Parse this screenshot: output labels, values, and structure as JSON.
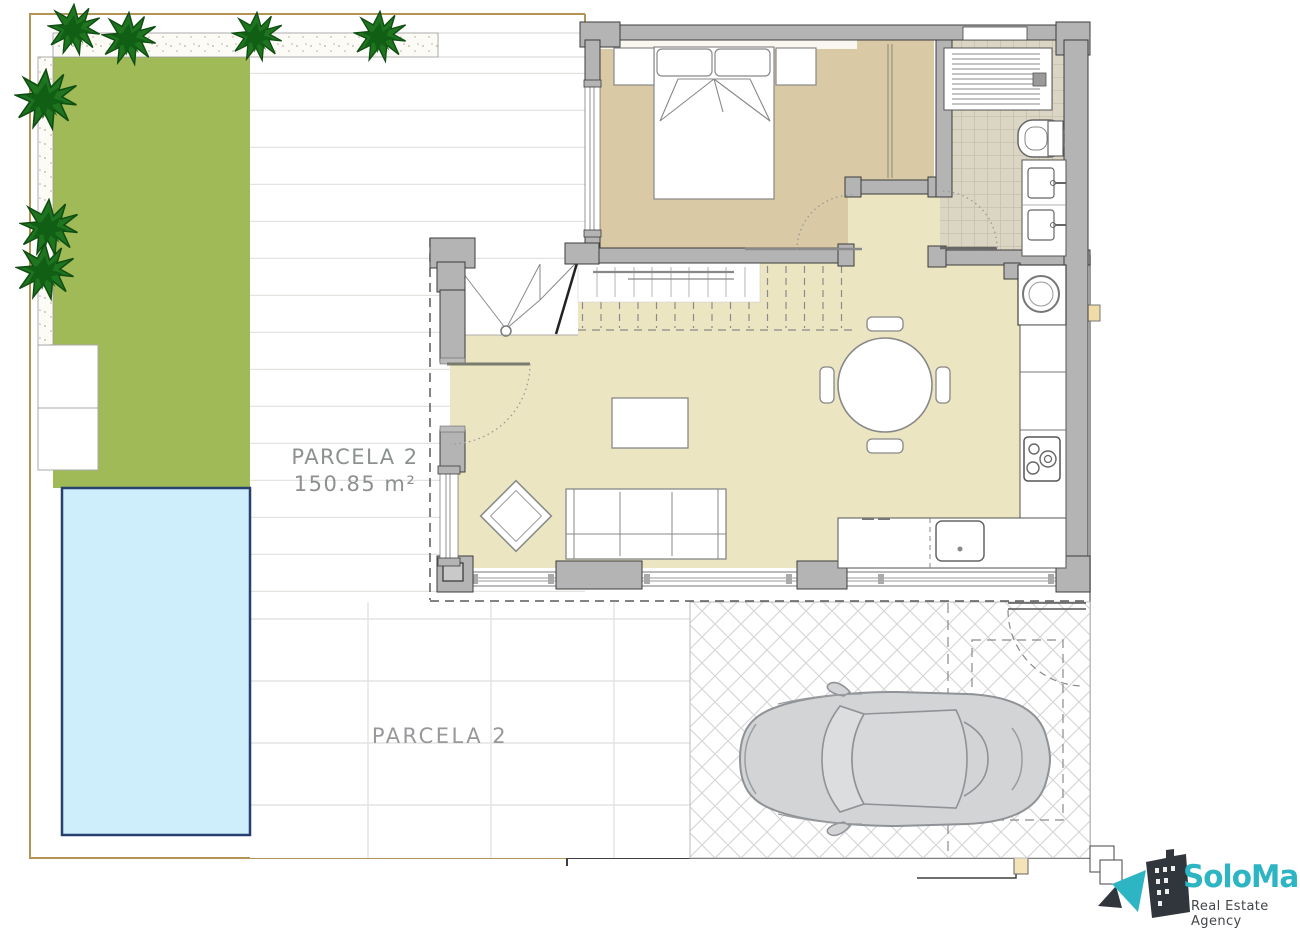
{
  "labels": {
    "parcel_main": {
      "title": "PARCELA 2",
      "area": "150.85 m²"
    },
    "parcel_bottom": {
      "title": "PARCELA 2"
    }
  },
  "logo": {
    "name": "SoloMar",
    "tagline": "Real Estate Agency"
  },
  "icons": {
    "tree": "tree-icon",
    "car": "car-top-view-icon",
    "bed": "double-bed-icon",
    "shower": "shower-icon",
    "toilet": "toilet-icon",
    "sink": "sink-icon",
    "washer": "washing-machine-icon",
    "hob": "cooktop-icon",
    "dining": "round-table-with-chairs-icon",
    "sofa": "sofa-icon",
    "logo_building": "building-icon"
  },
  "colors": {
    "wall": "#b4b4b4",
    "bedroom_floor": "#d9c9a4",
    "living_floor": "#ece5c2",
    "bath_tile": "#dbd6c3",
    "garden": "#9fba56",
    "pool_water": "#cdeefa",
    "pool_border": "#27406f",
    "tree": "#1e741f",
    "boundary": "#b29455",
    "logo_teal": "#2db5c3",
    "logo_dark": "#31363c",
    "car": "#d3d4d6",
    "label_text": "#8d9091"
  }
}
